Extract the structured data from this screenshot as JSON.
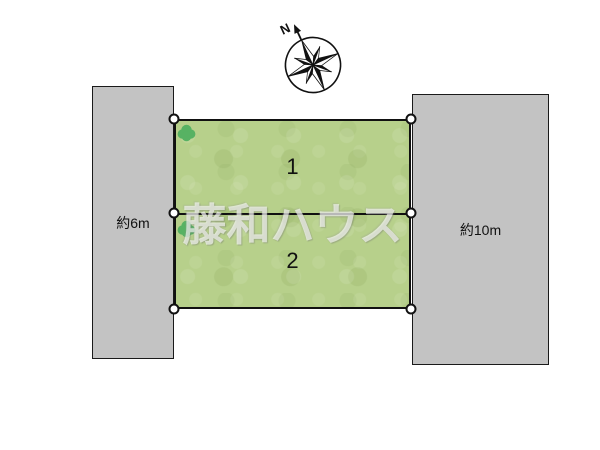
{
  "diagram": {
    "title": "lot layout plan",
    "compass": {
      "north_label": "N"
    },
    "roads": {
      "left": {
        "label": "約6m"
      },
      "right": {
        "label": "約10m"
      }
    },
    "plots": [
      {
        "number": "1"
      },
      {
        "number": "2"
      }
    ],
    "watermark": {
      "text": "藤和ハウス"
    },
    "colors": {
      "road_fill": "#c3c3c3",
      "plot_fill": "#b7d08b",
      "tree_fill": "#57b263",
      "outline": "#111111",
      "watermark": "rgba(255,255,255,0.62)"
    }
  }
}
